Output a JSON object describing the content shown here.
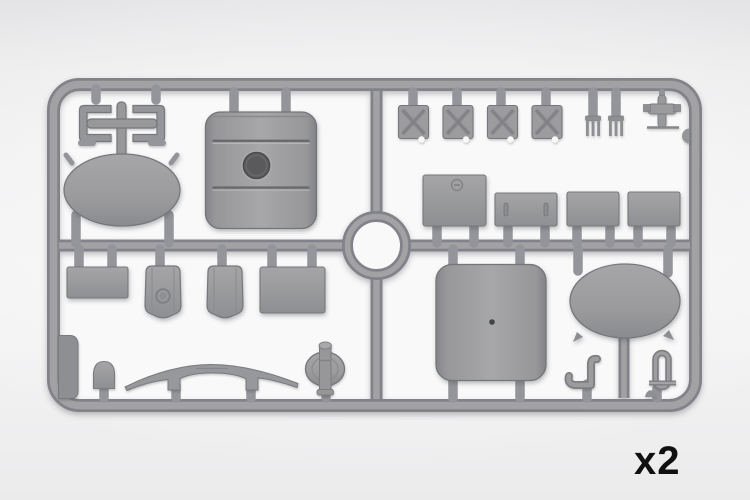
{
  "image": {
    "description": "Gray injection-molded plastic model kit sprue photographed on a light studio background",
    "frame_layout": "rounded-rectangle outer frame with one horizontal runner, one vertical runner and a circular ring at the center"
  },
  "annotation": {
    "quantity_label": "x2"
  },
  "colors": {
    "background_top": "#e4e4e6",
    "background": "#f3f3f4",
    "sprue_inner_area": "#f9f9fa",
    "plastic_mid": "#9b9b9e",
    "plastic_light": "#a7a7a9",
    "plastic_edge": "#82838a",
    "plastic_dark": "#76777b",
    "hole_dark": "#5a5a5d",
    "label_text": "#101010"
  },
  "sprue": {
    "parts": [
      {
        "name": "cross-brace-frame",
        "quadrant": "top-left",
        "count": 1
      },
      {
        "name": "curved-roof-panel-with-port",
        "quadrant": "top-left",
        "count": 1
      },
      {
        "name": "large-oval-panel",
        "quadrant": "top-left",
        "count": 1
      },
      {
        "name": "x-braced-hatch-panel",
        "quadrant": "top-right",
        "count": 4
      },
      {
        "name": "three-tine-fork",
        "quadrant": "top-right",
        "count": 2
      },
      {
        "name": "pin-with-side-blocks",
        "quadrant": "top-right",
        "count": 1
      },
      {
        "name": "box-lid-with-filler-cap",
        "quadrant": "right-middle",
        "count": 1
      },
      {
        "name": "slotted-rectangular-panel",
        "quadrant": "right-middle",
        "count": 1
      },
      {
        "name": "rectangular-panel",
        "quadrant": "right-middle",
        "count": 2
      },
      {
        "name": "wide-flat-plate",
        "quadrant": "bottom-left",
        "count": 1
      },
      {
        "name": "tapered-backrest-with-ring",
        "quadrant": "bottom-left",
        "count": 1
      },
      {
        "name": "tapered-backrest-plain",
        "quadrant": "bottom-left",
        "count": 1
      },
      {
        "name": "large-flat-plate",
        "quadrant": "bottom-left",
        "count": 1
      },
      {
        "name": "corner-wedge-block",
        "quadrant": "bottom-left",
        "count": 1
      },
      {
        "name": "dome-cap",
        "quadrant": "bottom-left",
        "count": 1
      },
      {
        "name": "arched-fender-strip",
        "quadrant": "bottom-left",
        "count": 1
      },
      {
        "name": "disc-with-axle-pin",
        "quadrant": "bottom-left",
        "count": 1
      },
      {
        "name": "curved-tank-panel",
        "quadrant": "bottom-right",
        "count": 1
      },
      {
        "name": "large-oval-panel",
        "quadrant": "bottom-right",
        "count": 1
      },
      {
        "name": "s-shaped-crank-bracket",
        "quadrant": "bottom-right",
        "count": 1
      },
      {
        "name": "shackle-pin-with-washer",
        "quadrant": "bottom-right",
        "count": 1
      }
    ]
  }
}
